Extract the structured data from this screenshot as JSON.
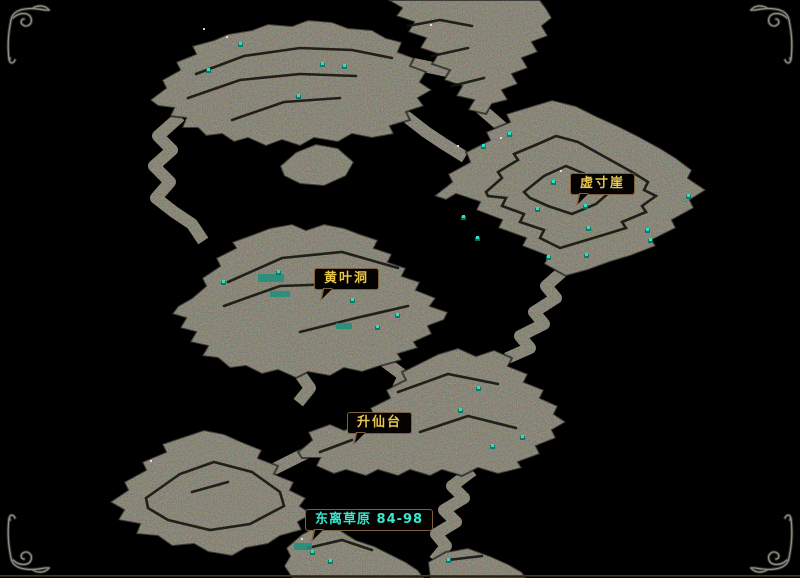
{
  "map": {
    "labels": [
      {
        "id": "xu-cun-ya",
        "text": "虚寸崖",
        "color": "#e8c64a"
      },
      {
        "id": "huang-ye-dong",
        "text": "黄叶洞",
        "color": "#e8c64a"
      },
      {
        "id": "sheng-xian-tai",
        "text": "升仙台",
        "color": "#e8c64a"
      },
      {
        "id": "dong-li-cao-yuan",
        "text": "东离草原 84-98",
        "color": "#38e8cf"
      }
    ],
    "colors": {
      "background": "#000000",
      "land_base": "#3b3930",
      "ridge": "#15140e",
      "monster_dot": "#27e2c5",
      "sparkle": "#e9e9e2",
      "water_patch": "#1e8f7d",
      "label_border": "#7e5f38",
      "label_background": "#040302",
      "label_text_gold": "#e8c64a",
      "label_text_cyan": "#38e8cf",
      "frame_ornament": "#8f8f86",
      "bottom_line": "#54422f"
    },
    "monsters": [
      [
        240,
        44
      ],
      [
        322,
        64
      ],
      [
        344,
        66
      ],
      [
        208,
        70
      ],
      [
        298,
        96
      ],
      [
        509,
        134
      ],
      [
        483,
        146
      ],
      [
        553,
        182
      ],
      [
        537,
        209
      ],
      [
        585,
        206
      ],
      [
        588,
        228
      ],
      [
        647,
        230
      ],
      [
        650,
        240
      ],
      [
        586,
        255
      ],
      [
        548,
        257
      ],
      [
        477,
        238
      ],
      [
        463,
        217
      ],
      [
        688,
        196
      ],
      [
        278,
        272
      ],
      [
        223,
        282
      ],
      [
        397,
        315
      ],
      [
        377,
        327
      ],
      [
        352,
        300
      ],
      [
        478,
        388
      ],
      [
        522,
        437
      ],
      [
        492,
        446
      ],
      [
        460,
        410
      ],
      [
        312,
        552
      ],
      [
        330,
        561
      ],
      [
        448,
        560
      ]
    ],
    "sparkles": [
      [
        203,
        28
      ],
      [
        226,
        36
      ],
      [
        500,
        137
      ],
      [
        457,
        145
      ],
      [
        150,
        460
      ],
      [
        301,
        538
      ],
      [
        560,
        170
      ],
      [
        430,
        24
      ]
    ],
    "water_patches": [
      [
        258,
        274,
        26,
        8
      ],
      [
        270,
        291,
        20,
        6
      ],
      [
        336,
        323,
        16,
        6
      ],
      [
        294,
        543,
        18,
        7
      ]
    ]
  },
  "frame": {
    "ornament": "filigree-corner-icon",
    "corners": [
      "top-left",
      "top-right",
      "bottom-left",
      "bottom-right"
    ]
  }
}
